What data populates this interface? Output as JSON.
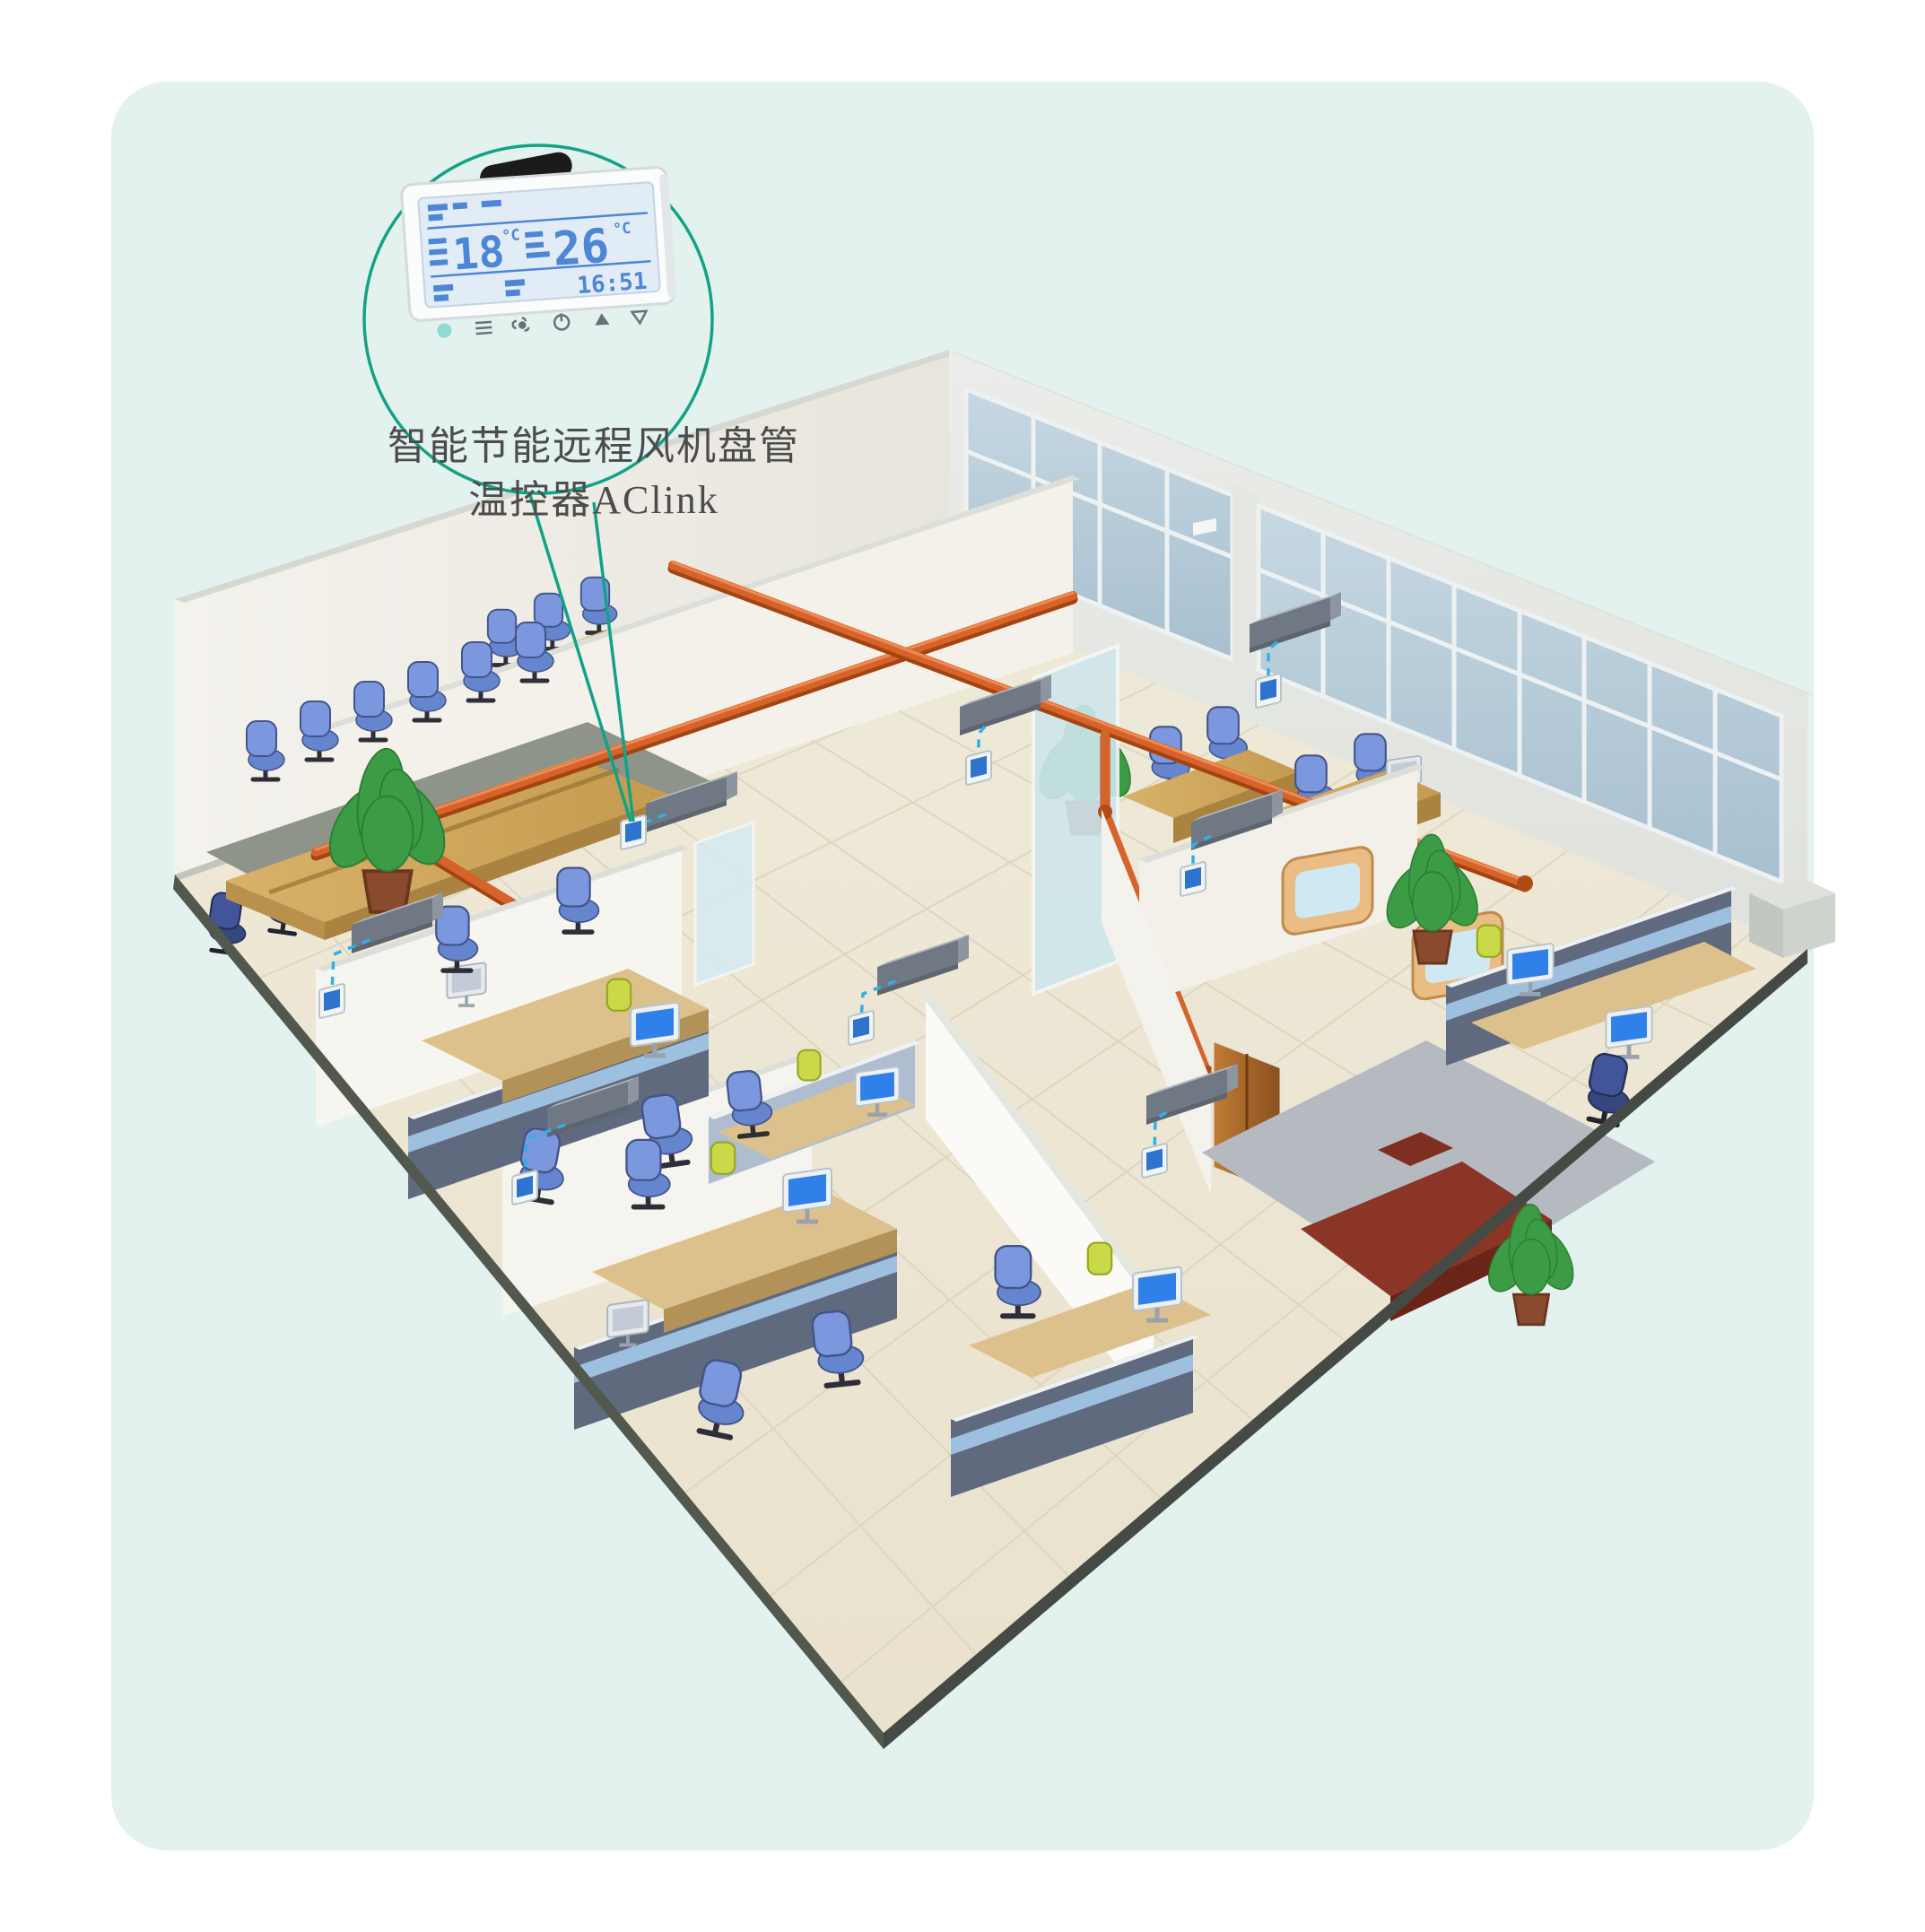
{
  "page": {
    "background": "#ffffff",
    "panel_bg": "#e3f2ee"
  },
  "callout": {
    "stroke_color": "#12a287",
    "label_line1": "智能节能远程风机盘管",
    "label_line2": "温控器AClink",
    "thermostat_device": {
      "body_color": "#fbfcfc",
      "display": {
        "room_temp": "18",
        "set_temp": "26",
        "temp_unit": "°C",
        "time": "16:51",
        "lcd_color": "#4d86d4"
      },
      "icons": [
        "status-dot-icon",
        "menu-icon",
        "fan-icon",
        "power-icon",
        "up-icon",
        "down-icon"
      ],
      "antenna": "wireless-antenna-icon"
    }
  },
  "scene": {
    "description": "Isometric cutaway office floor with fan coil units, wall thermostats, orange pipe runs, conference rooms, cubicle clusters and an executive office",
    "fan_coil_units": 8,
    "wall_thermostats": 8,
    "colors": {
      "pipe_orange": "#d6632b",
      "connector_blue": "#2fb0e8",
      "fan_coil_gray": "#78828c",
      "thermostat_screen": "#2e74cf",
      "window_glass": "#b5cbd8",
      "floor_tile": "#efe9d7",
      "wall_white": "#f2f0ea",
      "wood_desk": "#d2ab63",
      "chair_blue": "#7b97dd",
      "chair_lime": "#c9d94a",
      "exec_desk_red": "#8a3526"
    }
  }
}
